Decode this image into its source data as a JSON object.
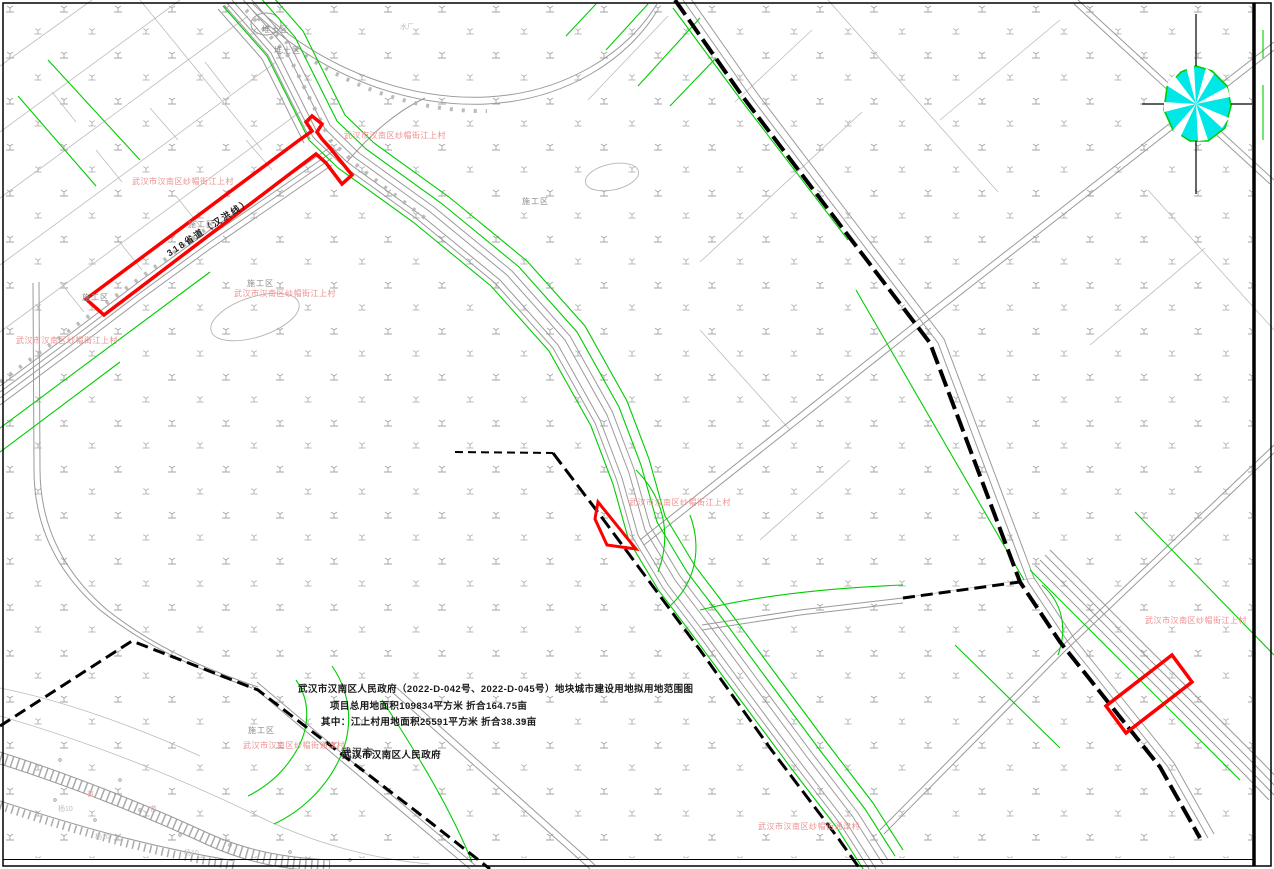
{
  "document_type": "land-use-planning-map",
  "title_block": {
    "line1": "武汉市汉南区人民政府（2022-D-042号、2022-D-045号）地块城市建设用地拟用地范围图",
    "line2": "项目总用地面积109834平方米  折合164.75亩",
    "line3": "其中：江上村用地面积25591平方米  折合38.39亩",
    "line4": "武汉市汉南区人民政府"
  },
  "labels": {
    "village_jiangshang": "武汉市汉南区纱帽街江上村",
    "village_tongjin": "武汉市汉南区纱帽街通津村",
    "area_dump": "堆土区",
    "area_construction": "施工区",
    "city_partial": "武汉市",
    "poplar_mark": "杨10",
    "nursery_mark": "苗",
    "waterworks": "水厂",
    "road_provincial": "318省道（汉洪线）"
  },
  "compass": {
    "symbol": "wind-rose"
  },
  "colors": {
    "parcel_outline_red": "#ff0000",
    "village_label_red": "#f08f8f",
    "utility_green": "#00cc00",
    "compass_cyan": "#00e7e7",
    "compass_green": "#00cc00",
    "road_gray": "#9a9a9a",
    "boundary_black": "#000000"
  }
}
